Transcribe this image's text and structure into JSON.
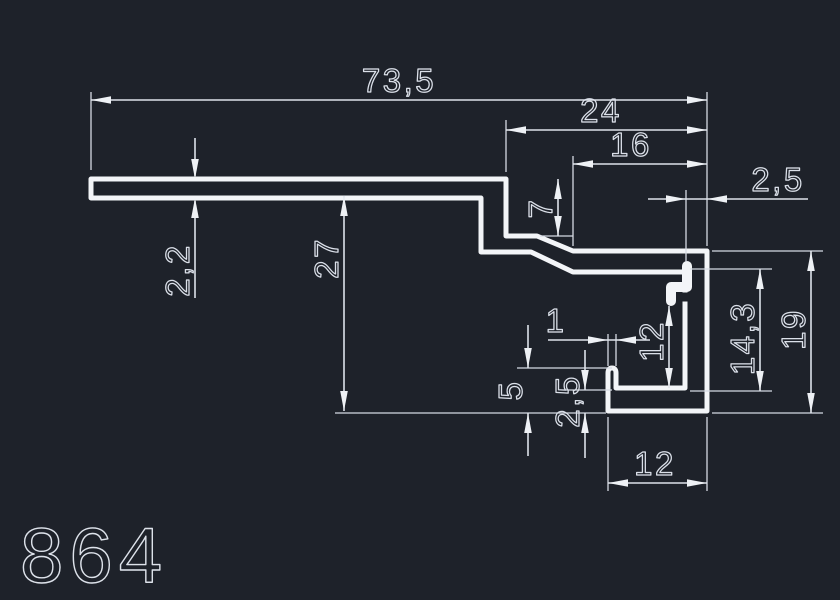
{
  "colors": {
    "background": "#1e222a",
    "profile_line": "#f3f5f8",
    "dimension_line": "#dde2ea",
    "text": "#dbe0e9"
  },
  "drawing": {
    "part_number": "864",
    "dim_labels": {
      "overall_width": "73,5",
      "right_section_width": "24",
      "top_face_width": "16",
      "wall_thickness": "2,5",
      "step_depth": "7",
      "flange_thickness": "2,2",
      "body_height": "27",
      "channel_height": "14,3",
      "right_height": "19",
      "lip_thickness": "1",
      "channel_inner_height": "12",
      "lip_height": "5",
      "bottom_thickness": "2,5",
      "bottom_width": "12"
    }
  }
}
